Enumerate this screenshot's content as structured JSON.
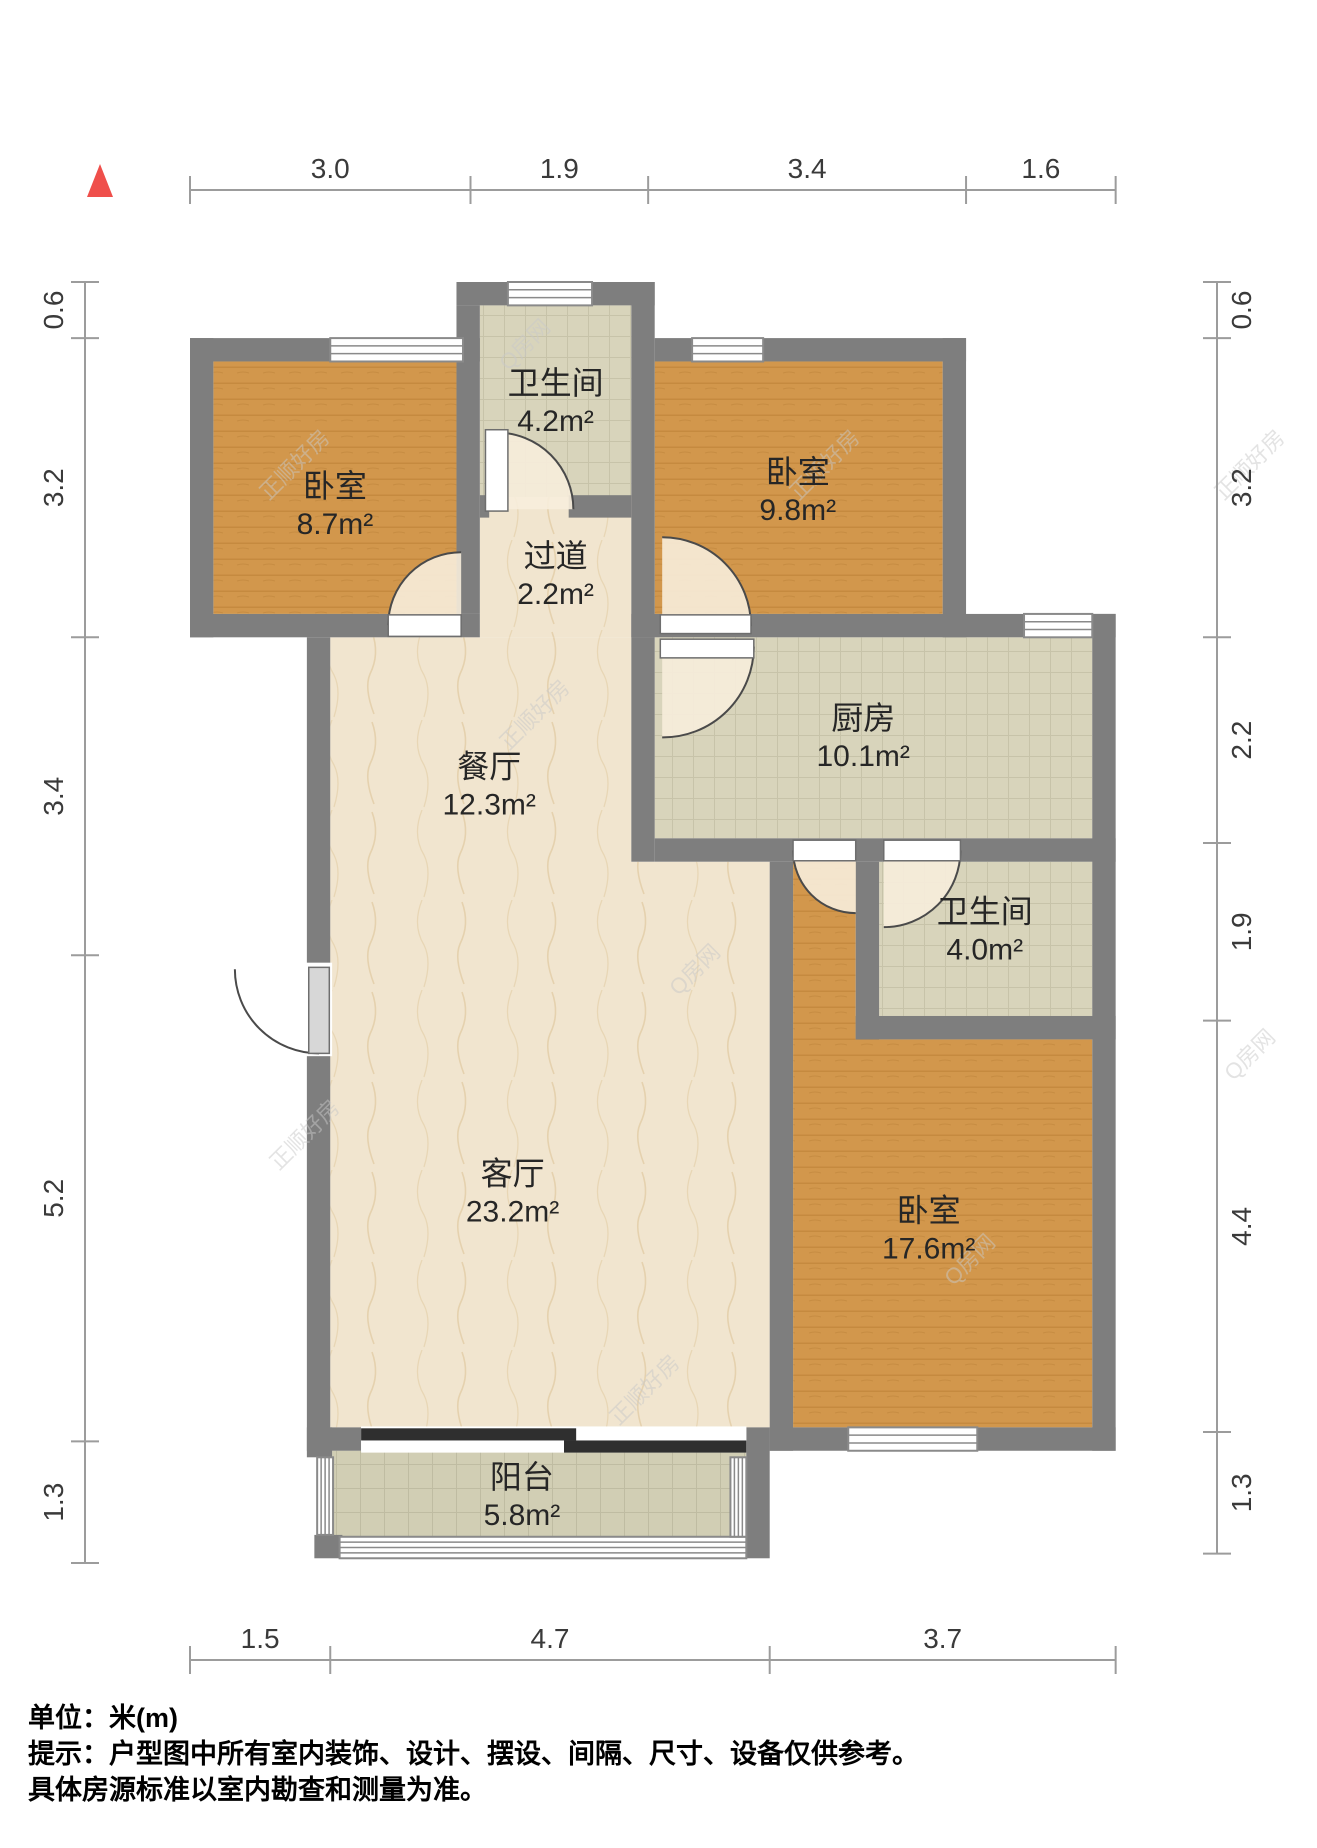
{
  "plan": {
    "canvas": {
      "w": 1317,
      "h": 1848
    },
    "origin_px": [
      190,
      282
    ],
    "scale_px_per_m": 93.5,
    "colors": {
      "wall": "#7E7E7E",
      "wood_base": "#D2974C",
      "wood_stripe": "#B97F35",
      "tile_base": "#D8D4BB",
      "tile_grid": "#C7C3A9",
      "btile_base": "#D1CEB4",
      "btile_grid": "#BFBCA2",
      "marble_base": "#F1E5CF",
      "marble_vein": "#E0C9A0",
      "window_frame": "#8a8a8a",
      "window_fill": "#FFFFFF",
      "door_arc": "#4A4A4A",
      "door_leaf": "#FFFFFF",
      "entry_leaf": "#D7D7D7",
      "door_sector": "#F7EDDC",
      "sliding": "#2F2F2F",
      "dim_line": "#9C9C9C",
      "dim_text": "#3A3A3A",
      "north": "#EF4F4B"
    },
    "floors": [
      {
        "id": "bedroom-top-left",
        "pattern": "wood",
        "rect": [
          0.25,
          0.85,
          2.6,
          2.7
        ]
      },
      {
        "id": "bathroom-top",
        "pattern": "tile",
        "rect": [
          3.1,
          0.25,
          1.62,
          2.05
        ]
      },
      {
        "id": "hallway",
        "pattern": "marble",
        "rect": [
          3.1,
          2.3,
          1.62,
          1.5
        ]
      },
      {
        "id": "bedroom-top-right",
        "pattern": "wood",
        "rect": [
          4.97,
          0.85,
          3.08,
          2.7
        ]
      },
      {
        "id": "kitchen",
        "pattern": "tile",
        "rect": [
          4.97,
          3.8,
          4.68,
          2.15
        ]
      },
      {
        "id": "dining-living",
        "pattern": "marble",
        "pts": [
          [
            3.1,
            3.8
          ],
          [
            4.72,
            3.8
          ],
          [
            4.72,
            6.2
          ],
          [
            6.2,
            6.2
          ],
          [
            6.2,
            12.25
          ],
          [
            1.5,
            12.25
          ],
          [
            1.5,
            3.8
          ]
        ]
      },
      {
        "id": "bathroom-right",
        "pattern": "tile",
        "rect": [
          7.37,
          6.2,
          2.28,
          1.65
        ]
      },
      {
        "id": "bedroom-right",
        "pattern": "wood",
        "pts": [
          [
            6.45,
            6.2
          ],
          [
            7.12,
            6.2
          ],
          [
            7.12,
            8.1
          ],
          [
            9.65,
            8.1
          ],
          [
            9.65,
            12.25
          ],
          [
            6.45,
            12.25
          ]
        ]
      },
      {
        "id": "balcony",
        "pattern": "btile",
        "rect": [
          1.52,
          12.5,
          4.43,
          0.95
        ]
      }
    ],
    "walls": [
      [
        0,
        0.6,
        3.1,
        0.25
      ],
      [
        2.85,
        0,
        2.12,
        0.25
      ],
      [
        0,
        0.6,
        0.25,
        3.2
      ],
      [
        0,
        3.55,
        3.1,
        0.25
      ],
      [
        2.85,
        0.25,
        0.25,
        3.3
      ],
      [
        4.72,
        0,
        0.25,
        3.8
      ],
      [
        3.1,
        2.28,
        0.1,
        0.24
      ],
      [
        4.05,
        2.28,
        0.67,
        0.24
      ],
      [
        4.97,
        0.6,
        3.33,
        0.25
      ],
      [
        8.05,
        0.6,
        0.25,
        3.2
      ],
      [
        4.72,
        3.55,
        5.18,
        0.25
      ],
      [
        9.65,
        3.55,
        0.25,
        8.95
      ],
      [
        4.72,
        3.8,
        0.25,
        2.4
      ],
      [
        4.97,
        5.95,
        4.93,
        0.25
      ],
      [
        7.12,
        6.2,
        0.25,
        1.9
      ],
      [
        7.12,
        7.85,
        2.78,
        0.25
      ],
      [
        6.2,
        6.2,
        0.25,
        6.3
      ],
      [
        6.2,
        12.25,
        3.7,
        0.25
      ],
      [
        1.25,
        3.8,
        0.25,
        8.7
      ],
      [
        1.5,
        12.25,
        0.33,
        0.25
      ],
      [
        5.95,
        12.25,
        0.25,
        1.4
      ],
      [
        1.25,
        12.25,
        0.27,
        0.32
      ],
      [
        1.33,
        13.4,
        0.3,
        0.25
      ]
    ],
    "windows": [
      {
        "id": "window-bedroom-top-left",
        "rect": [
          1.5,
          0.6,
          1.42,
          0.25
        ],
        "lines": 2,
        "orient": "h"
      },
      {
        "id": "window-bathroom-top",
        "rect": [
          3.4,
          0,
          0.9,
          0.25
        ],
        "lines": 2,
        "orient": "h"
      },
      {
        "id": "window-bedroom-top-right",
        "rect": [
          5.37,
          0.6,
          0.76,
          0.25
        ],
        "lines": 2,
        "orient": "h"
      },
      {
        "id": "window-kitchen",
        "rect": [
          8.92,
          3.55,
          0.73,
          0.25
        ],
        "lines": 2,
        "orient": "h"
      },
      {
        "id": "window-bedroom-right",
        "rect": [
          7.04,
          12.25,
          1.38,
          0.25
        ],
        "lines": 2,
        "orient": "h"
      }
    ],
    "railings": [
      {
        "id": "balcony-rail-left",
        "rect": [
          1.36,
          12.57,
          0.17,
          0.83
        ],
        "lines": 3,
        "orient": "v"
      },
      {
        "id": "balcony-rail-bottom",
        "rect": [
          1.6,
          13.42,
          4.35,
          0.23
        ],
        "lines": 3,
        "orient": "h"
      },
      {
        "id": "balcony-rail-right",
        "rect": [
          5.78,
          12.57,
          0.17,
          0.85
        ],
        "lines": 3,
        "orient": "v"
      }
    ],
    "sliding_door": {
      "backing": [
        1.83,
        12.24,
        4.12,
        0.28
      ],
      "bars": [
        [
          1.83,
          12.26,
          2.3,
          0.13
        ],
        [
          4.0,
          12.39,
          1.95,
          0.13
        ]
      ]
    },
    "doors": [
      {
        "id": "door-bathroom-top",
        "leaf": [
          3.16,
          1.58,
          0.24,
          0.87
        ],
        "hinge": [
          3.28,
          2.43
        ],
        "r": 0.82,
        "start": [
          3.28,
          1.61
        ],
        "end": [
          4.1,
          2.43
        ],
        "sweep": 1
      },
      {
        "id": "door-bedroom-top-left",
        "leaf": [
          2.12,
          3.56,
          0.78,
          0.23
        ],
        "hinge": [
          2.9,
          3.67
        ],
        "r": 0.78,
        "start": [
          2.12,
          3.67
        ],
        "end": [
          2.9,
          2.89
        ],
        "sweep": 1
      },
      {
        "id": "door-bedroom-top-right",
        "leaf": [
          5.03,
          3.56,
          0.97,
          0.2
        ],
        "hinge": [
          5.05,
          3.68
        ],
        "r": 0.95,
        "start": [
          6.0,
          3.68
        ],
        "end": [
          5.05,
          2.73
        ],
        "sweep": 0
      },
      {
        "id": "door-kitchen",
        "leaf": [
          5.03,
          3.82,
          1.0,
          0.2
        ],
        "hinge": [
          5.05,
          3.9
        ],
        "r": 0.97,
        "start": [
          6.03,
          3.9
        ],
        "end": [
          5.05,
          4.87
        ],
        "sweep": 1
      },
      {
        "id": "door-bedroom-right",
        "leaf": [
          6.45,
          5.97,
          0.67,
          0.22
        ],
        "hinge": [
          7.12,
          6.08
        ],
        "r": 0.67,
        "start": [
          6.45,
          6.08
        ],
        "end": [
          7.12,
          6.75
        ],
        "sweep": 0
      },
      {
        "id": "door-bathroom-right",
        "leaf": [
          7.42,
          5.97,
          0.82,
          0.22
        ],
        "hinge": [
          7.42,
          6.08
        ],
        "r": 0.82,
        "start": [
          8.24,
          6.08
        ],
        "end": [
          7.42,
          6.9
        ],
        "sweep": 1
      },
      {
        "id": "door-entrance",
        "leaf": [
          1.27,
          7.33,
          0.22,
          0.92
        ],
        "slot": [
          1.23,
          7.28,
          0.29,
          1.0
        ],
        "hinge": [
          1.38,
          7.35
        ],
        "r": 0.9,
        "start": [
          1.38,
          8.25
        ],
        "end": [
          0.48,
          7.35
        ],
        "sweep": 1,
        "leaf_fill": "entry",
        "sector_fill": "#FFFFFF"
      }
    ],
    "room_labels": [
      {
        "id": "bedroom-top-left",
        "name": "卧室",
        "area": "8.7m²",
        "at": [
          1.55,
          2.3
        ]
      },
      {
        "id": "bathroom-top",
        "name": "卫生间",
        "area": "4.2m²",
        "at": [
          3.91,
          1.2
        ]
      },
      {
        "id": "bedroom-top-right",
        "name": "卧室",
        "area": "9.8m²",
        "at": [
          6.5,
          2.15
        ]
      },
      {
        "id": "hallway",
        "name": "过道",
        "area": "2.2m²",
        "at": [
          3.91,
          3.05
        ]
      },
      {
        "id": "dining",
        "name": "餐厅",
        "area": "12.3m²",
        "at": [
          3.2,
          5.3
        ]
      },
      {
        "id": "kitchen",
        "name": "厨房",
        "area": "10.1m²",
        "at": [
          7.2,
          4.78
        ]
      },
      {
        "id": "bathroom-right",
        "name": "卫生间",
        "area": "4.0m²",
        "at": [
          8.5,
          6.85
        ]
      },
      {
        "id": "living",
        "name": "客厅",
        "area": "23.2m²",
        "at": [
          3.45,
          9.65
        ]
      },
      {
        "id": "bedroom-right",
        "name": "卧室",
        "area": "17.6m²",
        "at": [
          7.9,
          10.05
        ]
      },
      {
        "id": "balcony",
        "name": "阳台",
        "area": "5.8m²",
        "at": [
          3.55,
          12.9
        ]
      }
    ],
    "dimensions": [
      {
        "id": "top",
        "orient": "h",
        "line_px": 190,
        "segments": [
          [
            "3.0",
            3.0
          ],
          [
            "1.9",
            1.9
          ],
          [
            "3.4",
            3.4
          ],
          [
            "1.6",
            1.6
          ]
        ]
      },
      {
        "id": "bottom",
        "orient": "h",
        "line_px": 1660,
        "segments": [
          [
            "1.5",
            1.5
          ],
          [
            "4.7",
            4.7
          ],
          [
            "3.7",
            3.7
          ]
        ]
      },
      {
        "id": "left",
        "orient": "v",
        "line_px": 85,
        "side": -1,
        "segments": [
          [
            "0.6",
            0.6
          ],
          [
            "3.2",
            3.2
          ],
          [
            "3.4",
            3.4
          ],
          [
            "5.2",
            5.2
          ],
          [
            "1.3",
            1.3
          ]
        ]
      },
      {
        "id": "right",
        "orient": "v",
        "line_px": 1217,
        "side": 1,
        "segments": [
          [
            "0.6",
            0.6
          ],
          [
            "3.2",
            3.2
          ],
          [
            "2.2",
            2.2
          ],
          [
            "1.9",
            1.9
          ],
          [
            "4.4",
            4.4
          ],
          [
            "1.3",
            1.3
          ]
        ]
      }
    ],
    "north_indicator": {
      "points": "100,164 87,197 113,197"
    },
    "watermarks": [
      {
        "t": "正顺好房",
        "x": 300,
        "y": 470
      },
      {
        "t": "Q房网",
        "x": 530,
        "y": 350
      },
      {
        "t": "正顺好房",
        "x": 830,
        "y": 470
      },
      {
        "t": "正顺好房",
        "x": 1255,
        "y": 470
      },
      {
        "t": "正顺好房",
        "x": 310,
        "y": 1140
      },
      {
        "t": "Q房网",
        "x": 700,
        "y": 975
      },
      {
        "t": "正顺好房",
        "x": 650,
        "y": 1395
      },
      {
        "t": "Q房网",
        "x": 975,
        "y": 1265
      },
      {
        "t": "Q房网",
        "x": 1255,
        "y": 1060
      },
      {
        "t": "正顺好房",
        "x": 540,
        "y": 720
      }
    ]
  },
  "footer": {
    "line1": "单位：米(m)",
    "line2": "提示：户型图中所有室内装饰、设计、摆设、间隔、尺寸、设备仅供参考。",
    "line3": "具体房源标准以室内勘查和测量为准。"
  }
}
